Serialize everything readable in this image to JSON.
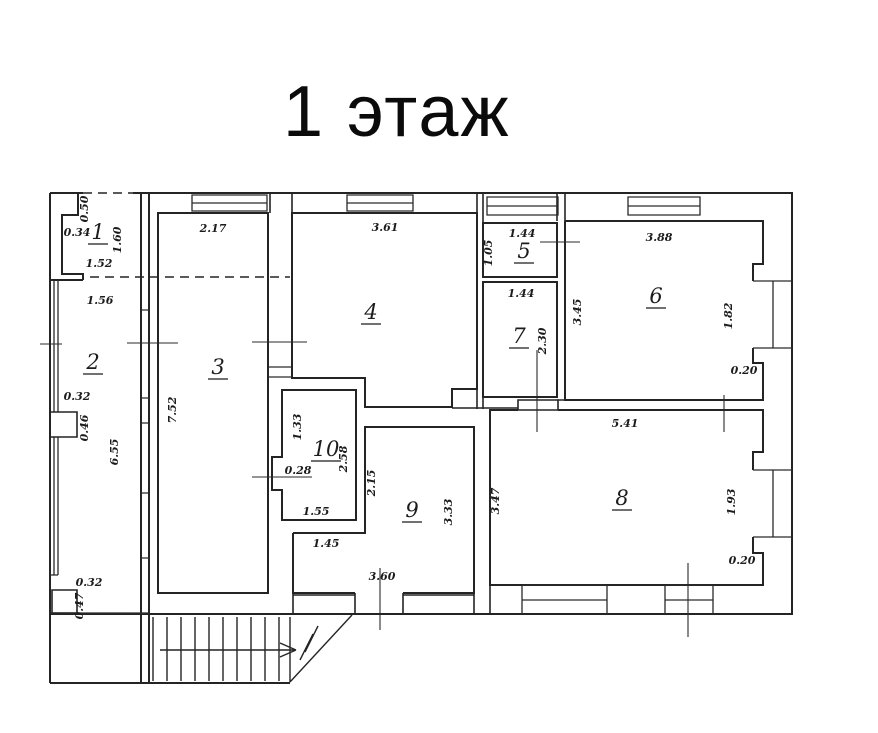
{
  "title": "1 этаж",
  "plan": {
    "rooms": [
      {
        "number": "1",
        "x": 98,
        "y": 239
      },
      {
        "number": "2",
        "x": 93,
        "y": 369
      },
      {
        "number": "3",
        "x": 218,
        "y": 374
      },
      {
        "number": "4",
        "x": 371,
        "y": 319
      },
      {
        "number": "5",
        "x": 524,
        "y": 258
      },
      {
        "number": "6",
        "x": 656,
        "y": 303
      },
      {
        "number": "7",
        "x": 519,
        "y": 343
      },
      {
        "number": "8",
        "x": 622,
        "y": 505
      },
      {
        "number": "9",
        "x": 412,
        "y": 517
      },
      {
        "number": "10",
        "x": 326,
        "y": 456
      }
    ],
    "dimensions": [
      {
        "text": "0.50",
        "x": 88,
        "y": 209,
        "rot": -90
      },
      {
        "text": "0.34",
        "x": 77,
        "y": 236
      },
      {
        "text": "1.60",
        "x": 121,
        "y": 240,
        "rot": -90
      },
      {
        "text": "1.52",
        "x": 99,
        "y": 267
      },
      {
        "text": "1.56",
        "x": 100,
        "y": 304
      },
      {
        "text": "0.32",
        "x": 77,
        "y": 400
      },
      {
        "text": "0.46",
        "x": 88,
        "y": 428,
        "rot": -90
      },
      {
        "text": "6.55",
        "x": 118,
        "y": 452,
        "rot": -90
      },
      {
        "text": "0.32",
        "x": 89,
        "y": 586
      },
      {
        "text": "0.47",
        "x": 83,
        "y": 606,
        "rot": -90
      },
      {
        "text": "2.17",
        "x": 213,
        "y": 232
      },
      {
        "text": "7.52",
        "x": 176,
        "y": 410,
        "rot": -90
      },
      {
        "text": "3.61",
        "x": 385,
        "y": 231
      },
      {
        "text": "1.44",
        "x": 522,
        "y": 237
      },
      {
        "text": "1.05",
        "x": 492,
        "y": 253,
        "rot": -90
      },
      {
        "text": "3.88",
        "x": 659,
        "y": 241
      },
      {
        "text": "3.45",
        "x": 581,
        "y": 312,
        "rot": -90
      },
      {
        "text": "1.82",
        "x": 732,
        "y": 316,
        "rot": -90
      },
      {
        "text": "0.20",
        "x": 744,
        "y": 374
      },
      {
        "text": "1.44",
        "x": 521,
        "y": 297
      },
      {
        "text": "2.30",
        "x": 546,
        "y": 341,
        "rot": -90
      },
      {
        "text": "1.33",
        "x": 301,
        "y": 427,
        "rot": -90
      },
      {
        "text": "2.58",
        "x": 347,
        "y": 459,
        "rot": -90
      },
      {
        "text": "0.28",
        "x": 298,
        "y": 474
      },
      {
        "text": "1.55",
        "x": 316,
        "y": 515
      },
      {
        "text": "2.15",
        "x": 375,
        "y": 483,
        "rot": -90
      },
      {
        "text": "3.33",
        "x": 452,
        "y": 512,
        "rot": -90
      },
      {
        "text": "1.45",
        "x": 326,
        "y": 547
      },
      {
        "text": "3.60",
        "x": 382,
        "y": 580
      },
      {
        "text": "5.41",
        "x": 625,
        "y": 427
      },
      {
        "text": "3.47",
        "x": 499,
        "y": 501,
        "rot": -90
      },
      {
        "text": "1.93",
        "x": 735,
        "y": 502,
        "rot": -90
      },
      {
        "text": "0.20",
        "x": 742,
        "y": 564
      }
    ]
  }
}
